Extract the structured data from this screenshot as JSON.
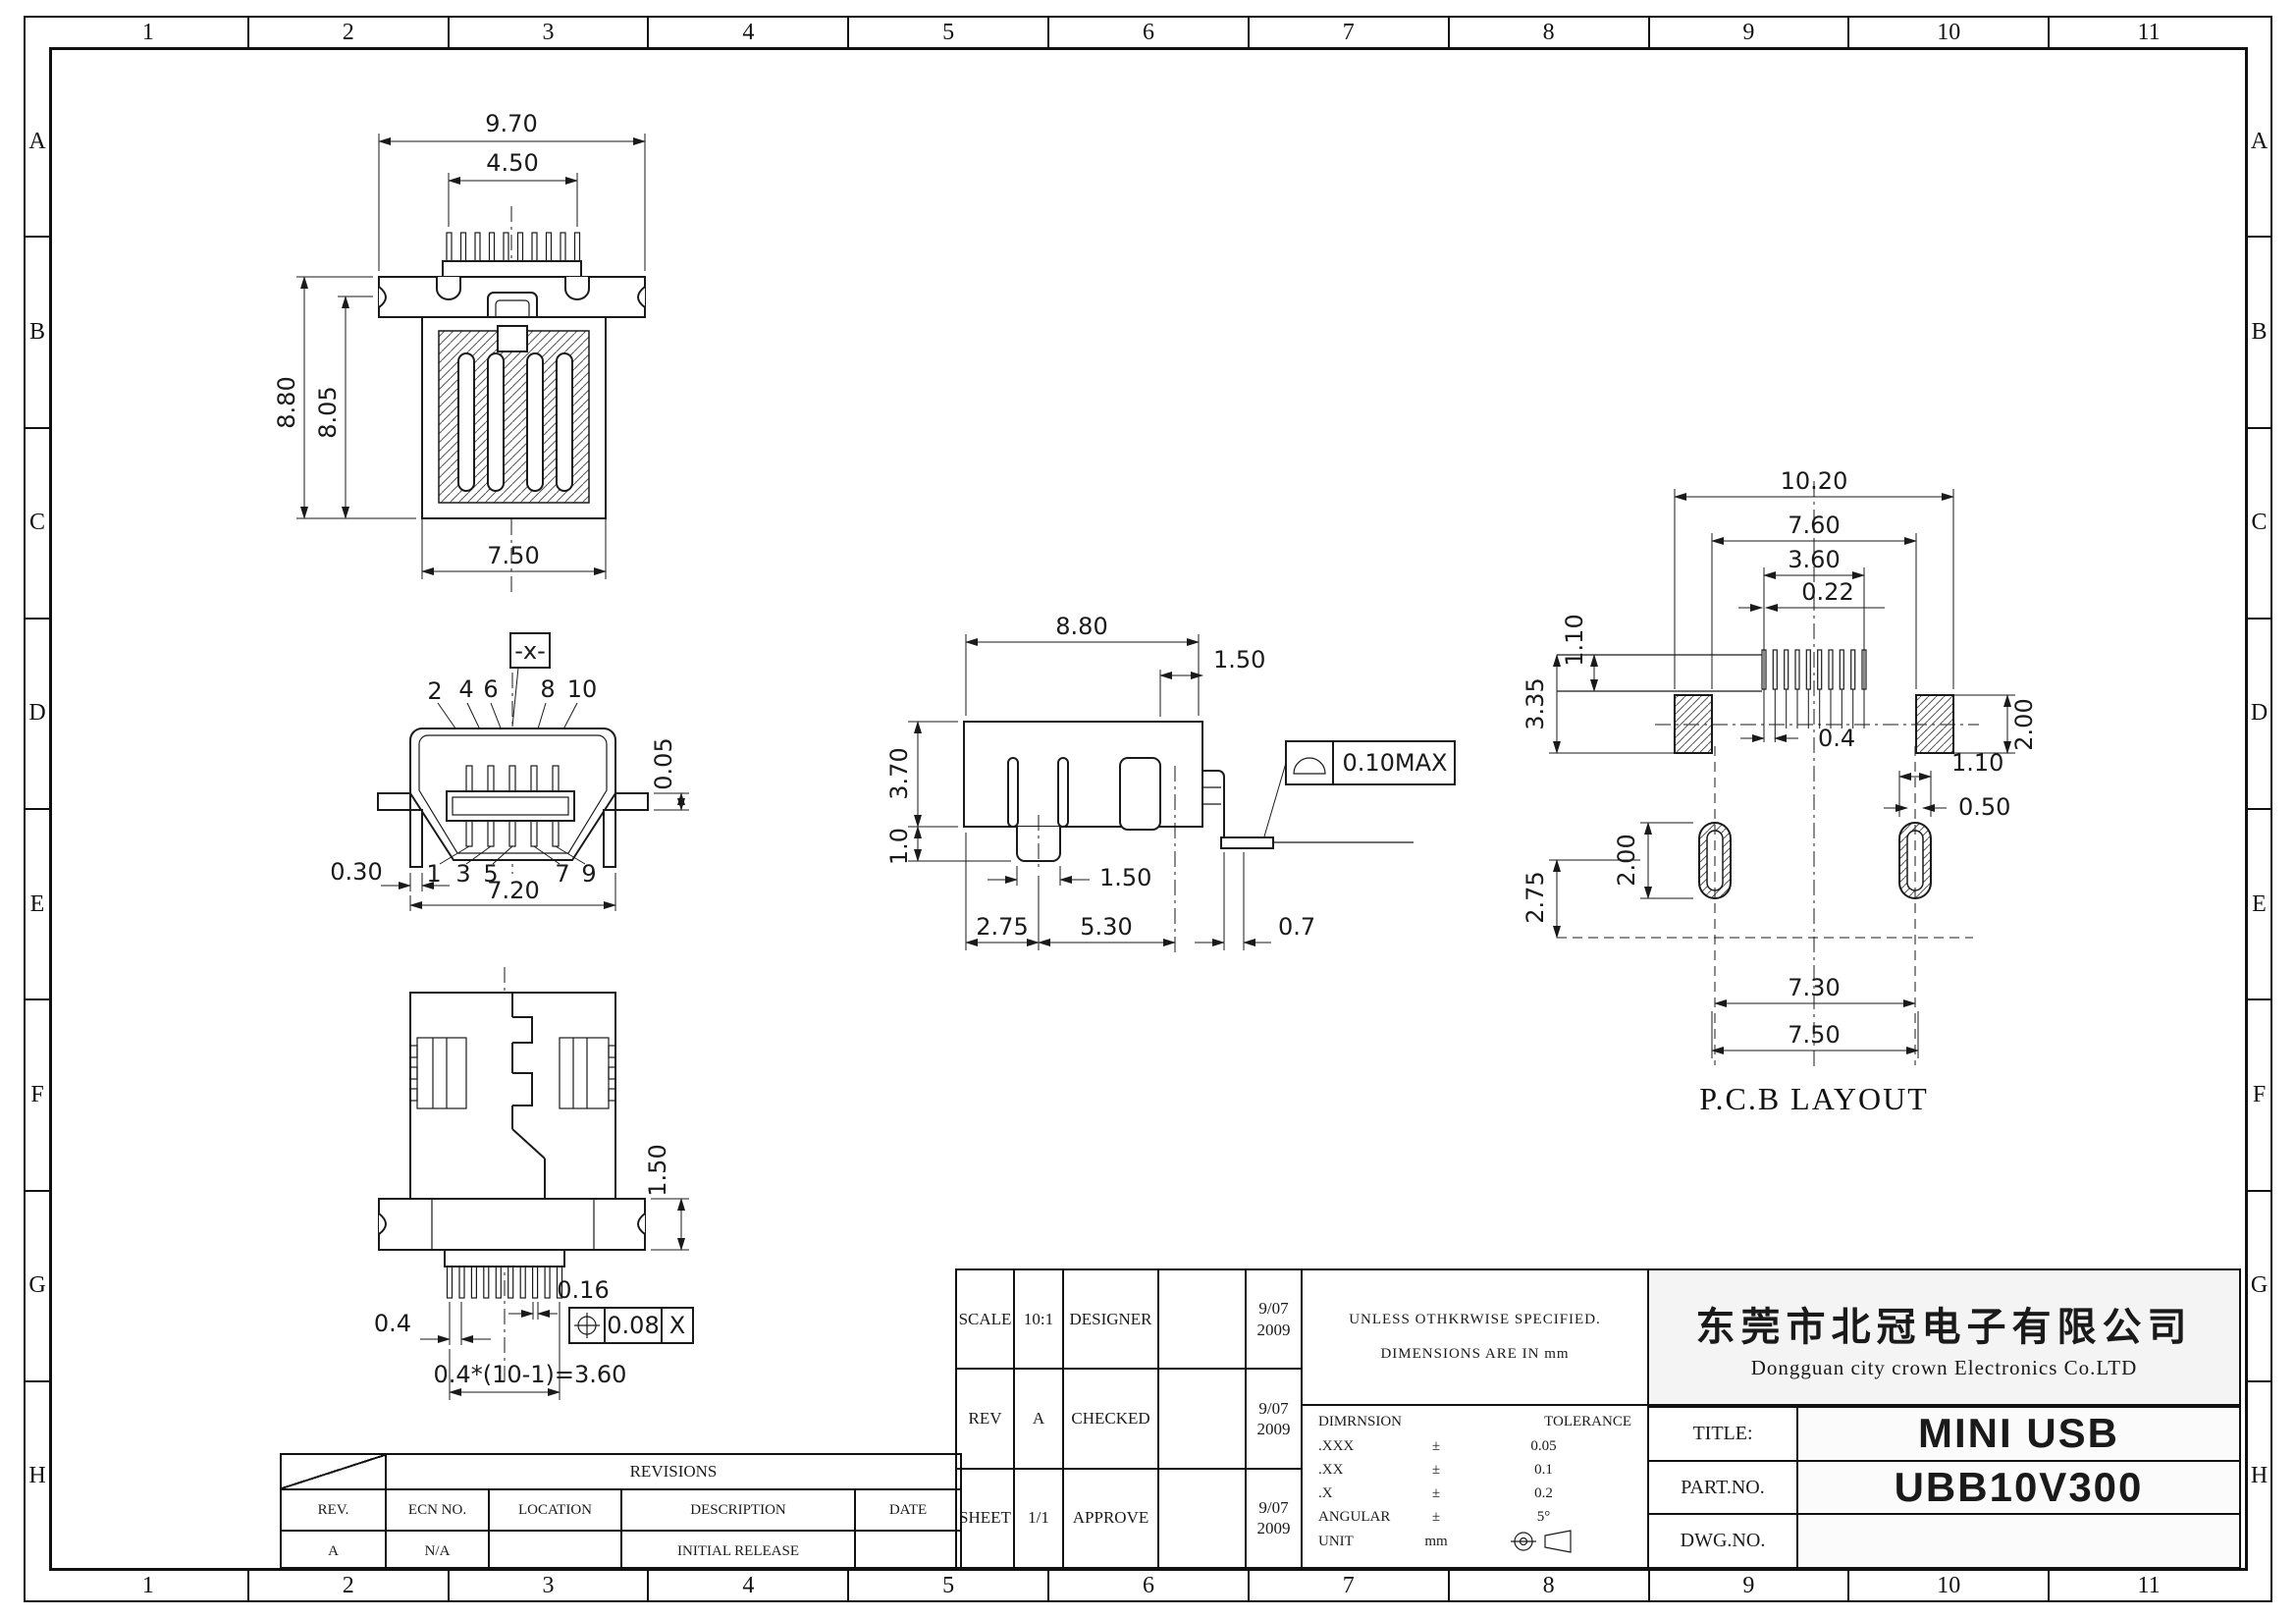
{
  "sheet": {
    "zone_cols": [
      "1",
      "2",
      "3",
      "4",
      "5",
      "6",
      "7",
      "8",
      "9",
      "10",
      "11"
    ],
    "zone_rows": [
      "A",
      "B",
      "C",
      "D",
      "E",
      "F",
      "G",
      "H"
    ],
    "line_color": "#1a1a1a",
    "bg_color": "#ffffff"
  },
  "views": {
    "top": {
      "d970": "9.70",
      "d450": "4.50",
      "d880": "8.80",
      "d805": "8.05",
      "d750": "7.50"
    },
    "front": {
      "datum": "-x-",
      "pins_top": [
        "2",
        "4",
        "6",
        "8",
        "10"
      ],
      "pins_bottom": [
        "1",
        "3",
        "5",
        "7",
        "9"
      ],
      "d005": "0.05",
      "d030": "0.30",
      "d720": "7.20"
    },
    "side": {
      "d880": "8.80",
      "d150top": "1.50",
      "d370": "3.70",
      "d10": "1.0",
      "d150tab": "1.50",
      "d275": "2.75",
      "d530": "5.30",
      "d07": "0.7",
      "flatness": "0.10MAX"
    },
    "pcb": {
      "label": "P.C.B LAYOUT",
      "d1020": "10.20",
      "d760": "7.60",
      "d360": "3.60",
      "d022": "0.22",
      "d110a": "1.10",
      "d335": "3.35",
      "d200a": "2.00",
      "d04": "0.4",
      "d110b": "1.10",
      "d050": "0.50",
      "d200b": "2.00",
      "d275": "2.75",
      "d730": "7.30",
      "d750": "7.50"
    },
    "bottom": {
      "d150": "1.50",
      "d04": "0.4",
      "d016": "0.16",
      "fcf_val": "0.08",
      "fcf_datum": "X",
      "pitch": "0.4*(10-1)=3.60"
    }
  },
  "revisions": {
    "title": "REVISIONS",
    "headers": [
      "REV.",
      "ECN NO.",
      "LOCATION",
      "DESCRIPTION",
      "DATE"
    ],
    "rows": [
      [
        "A",
        "N/A",
        "",
        "INITIAL RELEASE",
        ""
      ]
    ]
  },
  "titleblock": {
    "scale_label": "SCALE",
    "scale": "10:1",
    "designer_label": "DESIGNER",
    "designer_date": "9/07\n2009",
    "rev_label": "REV",
    "rev": "A",
    "checked_label": "CHECKED",
    "checked_date": "9/07\n2009",
    "sheet_label": "SHEET",
    "sheet": "1/1",
    "approve_label": "APPROVE",
    "approve_date": "9/07\n2009",
    "note1": "UNLESS OTHKRWISE SPECIFIED.",
    "note2": "DIMENSIONS ARE IN mm",
    "tol_header_dim": "DIMRNSION",
    "tol_header_tol": "TOLERANCE",
    "tol_rows": [
      [
        ".XXX",
        "±",
        "0.05"
      ],
      [
        ".XX",
        "±",
        "0.1"
      ],
      [
        ".X",
        "±",
        "0.2"
      ],
      [
        "ANGULAR",
        "±",
        "5°"
      ]
    ],
    "unit_label": "UNIT",
    "unit": "mm",
    "company_cn": "东莞市北冠电子有限公司",
    "company_en": "Dongguan city crown Electronics Co.LTD",
    "title_label": "TITLE:",
    "title": "MINI USB",
    "part_label": "PART.NO.",
    "part": "UBB10V300",
    "dwg_label": "DWG.NO.",
    "dwg": ""
  }
}
